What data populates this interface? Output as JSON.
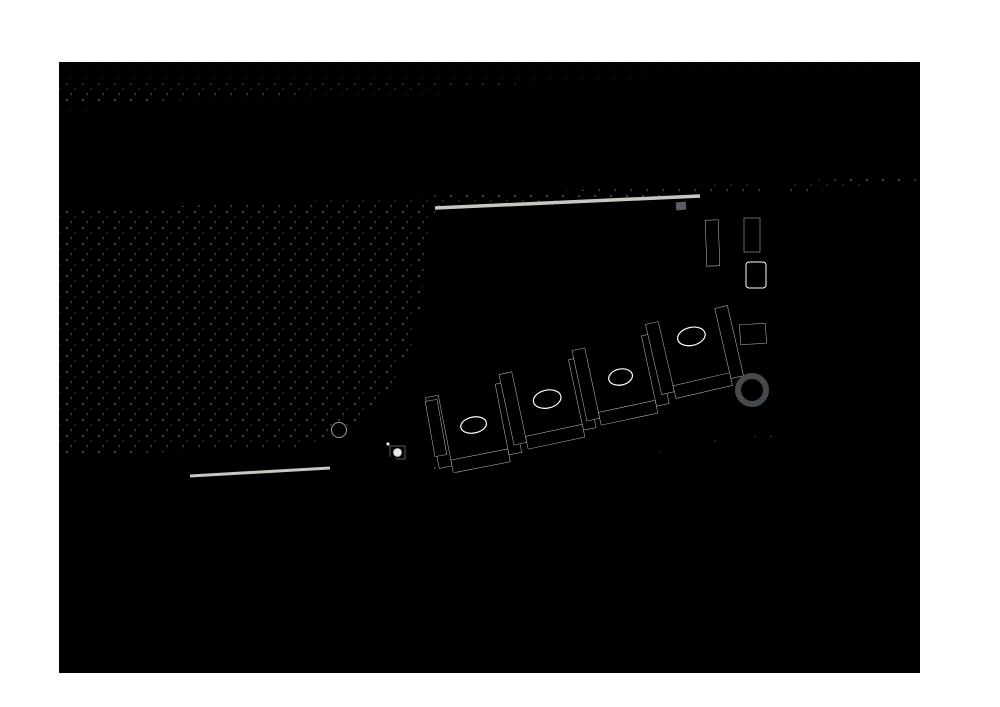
{
  "meta": {
    "description": "Aerial masterplan rendering: desert development with highway, loop road, golf park with ponds, crystal lagoon, residential clusters and industrial district",
    "street_label": "5 Street"
  },
  "palette": {
    "page_bg": "#ffffff",
    "sand": "#e4e1d8",
    "sand_top": "#eceae2",
    "sand_speckle": "#c9c5b8",
    "desert_patch": "#cbc7bf",
    "desert_white": "#f0eee6",
    "highway": "#616467",
    "highway_median": "#989a9d",
    "highway_shoulder": "#888b8e",
    "road": "#46494c",
    "road_center": "#7a7d80",
    "light_road": "#c8c6c0",
    "tree_dark": "#4a6f3c",
    "tree_mid": "#5d8549",
    "tree_light": "#7fa566",
    "green_base": "#b3c78c",
    "grass_light": "#c8d89b",
    "grass_dark": "#9dbb72",
    "park_sand": "#d2c5a3",
    "pond": "#66c2d8",
    "lagoon": "#8fd2e2",
    "beach": "#e9f5f6",
    "pool": "#3fa7cd",
    "pool_dark": "#2a6d98",
    "roof_white": "#f1efe8",
    "roof_line": "#c9c7bf",
    "plaza": "#9b9c98",
    "industrial_base": "#d6d6d3",
    "light": "#e8e8e5",
    "mid": "#cbcbc8",
    "dark": "#b3b3b0",
    "blue": "#ccd7de",
    "shadow": "#7d8686"
  },
  "highway": {
    "lane_ts": [
      0.1,
      0.165,
      0.23,
      0.425,
      0.49,
      0.555,
      0.735,
      0.8,
      0.865
    ]
  },
  "desert": {
    "parcel_lines": [
      [
        203,
        242,
        207,
        455
      ],
      [
        265,
        236,
        270,
        458
      ],
      [
        332,
        238,
        337,
        446
      ],
      [
        150,
        351,
        418,
        344
      ],
      [
        376,
        250,
        380,
        420
      ]
    ],
    "gray_patches": [
      [
        120,
        252,
        34,
        13
      ],
      [
        88,
        278,
        22,
        10
      ],
      [
        165,
        240,
        20,
        8
      ],
      [
        320,
        300,
        28,
        12
      ],
      [
        230,
        392,
        32,
        14
      ],
      [
        150,
        432,
        24,
        10
      ],
      [
        370,
        270,
        18,
        8
      ],
      [
        95,
        370,
        20,
        9
      ],
      [
        260,
        330,
        22,
        9
      ],
      [
        250,
        95,
        30,
        8
      ]
    ],
    "white_patches": [
      [
        140,
        300,
        30,
        12
      ],
      [
        200,
        350,
        26,
        10
      ],
      [
        300,
        250,
        24,
        9
      ],
      [
        100,
        320,
        18,
        8
      ],
      [
        150,
        85,
        40,
        10
      ],
      [
        400,
        80,
        50,
        9
      ],
      [
        650,
        75,
        40,
        8
      ]
    ]
  },
  "park": {
    "ponds": [
      [
        492,
        283,
        15,
        21,
        -20
      ],
      [
        549,
        267,
        19,
        13,
        -15
      ],
      [
        563,
        247,
        12,
        9,
        20
      ],
      [
        612,
        236,
        14,
        8,
        -8
      ],
      [
        668,
        247,
        11,
        20,
        12
      ],
      [
        638,
        283,
        19,
        12,
        -4
      ],
      [
        700,
        262,
        7,
        11,
        0
      ],
      [
        465,
        305,
        9,
        6,
        0
      ]
    ],
    "sand_patches": [
      [
        455,
        250,
        38,
        26,
        -18
      ],
      [
        505,
        312,
        40,
        18,
        -5
      ],
      [
        588,
        293,
        30,
        14,
        8
      ],
      [
        657,
        252,
        22,
        12,
        0
      ],
      [
        693,
        300,
        20,
        11,
        -10
      ],
      [
        530,
        214,
        26,
        9,
        -3
      ],
      [
        616,
        210,
        18,
        8,
        0
      ],
      [
        448,
        310,
        16,
        8,
        0
      ]
    ],
    "grass_patches": [
      [
        468,
        262,
        30,
        18,
        15
      ],
      [
        560,
        232,
        34,
        14,
        -5
      ],
      [
        640,
        305,
        26,
        12,
        0
      ],
      [
        688,
        228,
        20,
        12,
        0
      ],
      [
        520,
        290,
        24,
        12,
        10
      ],
      [
        600,
        265,
        22,
        10,
        0
      ]
    ]
  },
  "industrial": {
    "warehouses": [
      [
        63,
        545,
        42,
        36,
        "light",
        0
      ],
      [
        63,
        588,
        42,
        42,
        "mid",
        0
      ],
      [
        63,
        637,
        38,
        30,
        "mid",
        0
      ],
      [
        132,
        556,
        34,
        24,
        "mid",
        2
      ],
      [
        172,
        580,
        42,
        28,
        "light",
        0
      ],
      [
        138,
        616,
        52,
        32,
        "mid",
        3
      ],
      [
        262,
        545,
        32,
        62,
        "light",
        0
      ],
      [
        260,
        614,
        34,
        52,
        "mid",
        0
      ],
      [
        300,
        550,
        64,
        106,
        "blue",
        0
      ],
      [
        372,
        552,
        30,
        46,
        "mid",
        0
      ],
      [
        300,
        660,
        70,
        10,
        "light",
        0
      ],
      [
        436,
        515,
        148,
        16,
        "light",
        -1
      ],
      [
        436,
        536,
        148,
        13,
        "mid",
        -1
      ],
      [
        436,
        553,
        148,
        12,
        "light",
        -1
      ],
      [
        436,
        569,
        148,
        17,
        "mid",
        -1
      ],
      [
        436,
        590,
        148,
        16,
        "light",
        -1
      ],
      [
        436,
        610,
        148,
        14,
        "mid",
        -1
      ],
      [
        436,
        628,
        148,
        16,
        "light",
        -1
      ],
      [
        436,
        648,
        148,
        12,
        "mid",
        -1
      ],
      [
        468,
        466,
        34,
        20,
        "mid",
        4
      ],
      [
        535,
        474,
        38,
        16,
        "light",
        -2
      ],
      [
        628,
        490,
        54,
        40,
        "mid",
        2
      ],
      [
        692,
        478,
        64,
        52,
        "light",
        1
      ],
      [
        758,
        470,
        24,
        60,
        "mid",
        0
      ],
      [
        622,
        560,
        70,
        30,
        "mid",
        0
      ],
      [
        700,
        558,
        70,
        32,
        "light",
        0
      ],
      [
        620,
        598,
        148,
        28,
        "light",
        0
      ],
      [
        620,
        632,
        148,
        26,
        "mid",
        0
      ],
      [
        806,
        468,
        58,
        48,
        "mid",
        0
      ],
      [
        808,
        524,
        84,
        44,
        "light",
        0
      ],
      [
        804,
        576,
        94,
        54,
        "light",
        0
      ],
      [
        804,
        636,
        94,
        28,
        "mid",
        0
      ],
      [
        828,
        208,
        72,
        48,
        "light",
        -2
      ],
      [
        814,
        276,
        58,
        66,
        "mid",
        0
      ],
      [
        842,
        352,
        68,
        56,
        "light",
        -1
      ],
      [
        902,
        390,
        16,
        34,
        "mid",
        0
      ],
      [
        62,
        470,
        60,
        34,
        "light",
        -2
      ],
      [
        130,
        466,
        46,
        30,
        "mid",
        -3
      ]
    ],
    "debris": [
      [
        214,
        590,
        8
      ],
      [
        182,
        648,
        6
      ],
      [
        248,
        562,
        5
      ],
      [
        872,
        250,
        9
      ],
      [
        848,
        322,
        7
      ],
      [
        890,
        300,
        6
      ],
      [
        540,
        495,
        5
      ],
      [
        665,
        520,
        6
      ]
    ],
    "faint_streets": [
      [
        818,
        182,
        812,
        437
      ],
      [
        800,
        262,
        920,
        252
      ],
      [
        800,
        352,
        920,
        345
      ]
    ]
  },
  "townhouses": {
    "row1": [
      [
        183,
        484,
        29,
        11
      ],
      [
        216,
        484,
        29,
        11
      ],
      [
        249,
        484,
        29,
        11
      ],
      [
        282,
        484,
        29,
        11
      ],
      [
        315,
        484,
        29,
        11
      ]
    ],
    "row2": [
      [
        199,
        502,
        29,
        11
      ],
      [
        232,
        502,
        29,
        11
      ],
      [
        265,
        502,
        29,
        11
      ],
      [
        298,
        502,
        29,
        11
      ]
    ]
  }
}
